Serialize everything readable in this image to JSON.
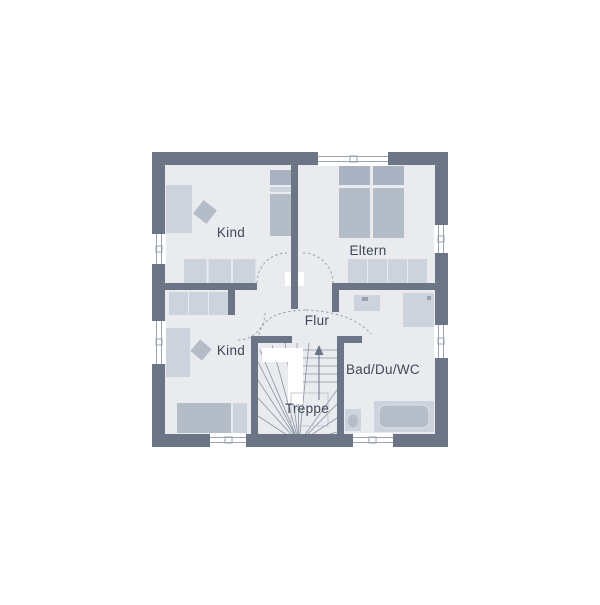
{
  "plan": {
    "title": "Obergeschoss Grundriss",
    "rooms": [
      {
        "id": "kind-top",
        "label": "Kind"
      },
      {
        "id": "eltern",
        "label": "Eltern"
      },
      {
        "id": "flur",
        "label": "Flur"
      },
      {
        "id": "kind-bottom",
        "label": "Kind"
      },
      {
        "id": "bad",
        "label": "Bad/Du/WC"
      },
      {
        "id": "treppe",
        "label": "Treppe"
      }
    ]
  },
  "colors": {
    "wall": "#6b7586",
    "floor": "#e9ebef",
    "furniture_light": "#cdd3dc",
    "furniture_mid": "#b4bcc8",
    "furniture_dark": "#a9b2c0",
    "line": "#9aa3b0",
    "stair_line": "#8a93a2",
    "text": "#3e4857",
    "background": "#ffffff"
  }
}
